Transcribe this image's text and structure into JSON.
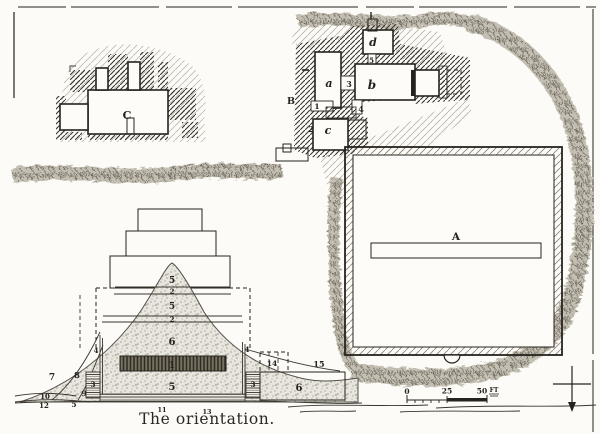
{
  "figure": {
    "caption": "The orientation.",
    "paper_color": "#fcfbf7",
    "ink_color": "#26231e",
    "stipple_color": "#a9a49a",
    "vegetation_color": "#8b857a"
  },
  "buildings": {
    "enclosure": "A",
    "temple": "B",
    "mastaba": "C"
  },
  "rooms": {
    "a": "a",
    "b": "b",
    "c": "c",
    "d": "d"
  },
  "plan_numbers": {
    "n1": "1",
    "n2": "2",
    "n3": "3",
    "n4": "4",
    "n5": "5"
  },
  "section": {
    "layers": [
      "5",
      "2",
      "5",
      "2",
      "6",
      "1",
      "5"
    ],
    "left": [
      "7",
      "8",
      "9",
      "10",
      "12",
      "5",
      "3",
      "4"
    ],
    "right": [
      "4",
      "3",
      "14",
      "15",
      "6"
    ],
    "base": [
      "11",
      "13"
    ]
  },
  "scale_bar": {
    "zero": "0",
    "mid": "25",
    "end": "50",
    "unit": "FT"
  }
}
